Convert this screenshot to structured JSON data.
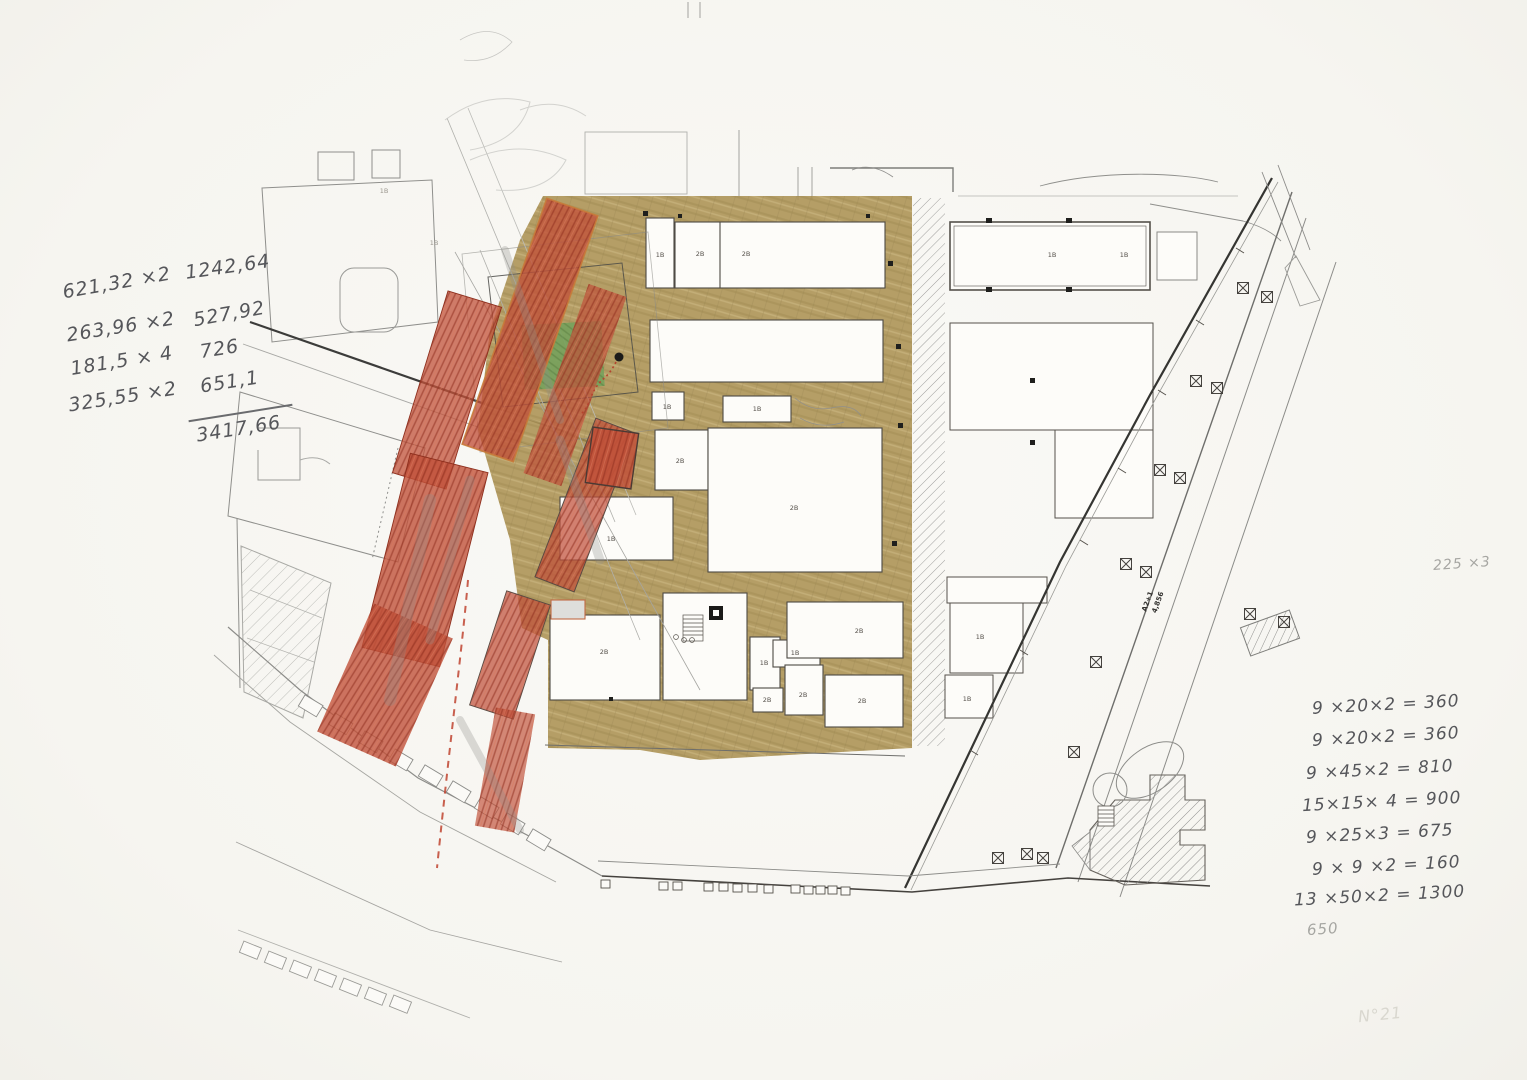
{
  "annotations": {
    "left_calc": {
      "lines": [
        {
          "expr": "621,32 ×2",
          "result": "1242,64"
        },
        {
          "expr": "263,96 ×2",
          "result": "527,92"
        },
        {
          "expr": "181,5 × 4",
          "result": "726"
        },
        {
          "expr": "325,55 ×2",
          "result": "651,1"
        }
      ],
      "total": "3417,66"
    },
    "right_calc": {
      "lines": [
        "9 ×20×2  = 360",
        "9 ×20×2  = 360",
        "9 ×45×2  = 810",
        "15×15× 4  = 900",
        "9 ×25×3  = 675",
        "9 × 9 ×2 =  160",
        "13 ×50×2 = 1300"
      ],
      "below": "650"
    },
    "side_note": "225 ×3",
    "corner_mark": "N°21"
  },
  "plan": {
    "road_label_line1": "A2+1",
    "road_label_line2": "4,856",
    "building_labels": [
      "1B",
      "2B",
      "2B",
      "1B",
      "1B",
      "2B",
      "2B",
      "1B",
      "2B",
      "1B",
      "1B",
      "2B",
      "2B",
      "2B",
      "2B",
      "1B",
      "1B",
      "1B",
      "1B",
      "1B",
      "1B"
    ]
  },
  "colors": {
    "paper": "#f8f7f3",
    "ground_tan": "#ac9253",
    "massing_red": "#c1513a",
    "park_green": "#76a15c",
    "pencil_gray": "#8a8a8a"
  }
}
